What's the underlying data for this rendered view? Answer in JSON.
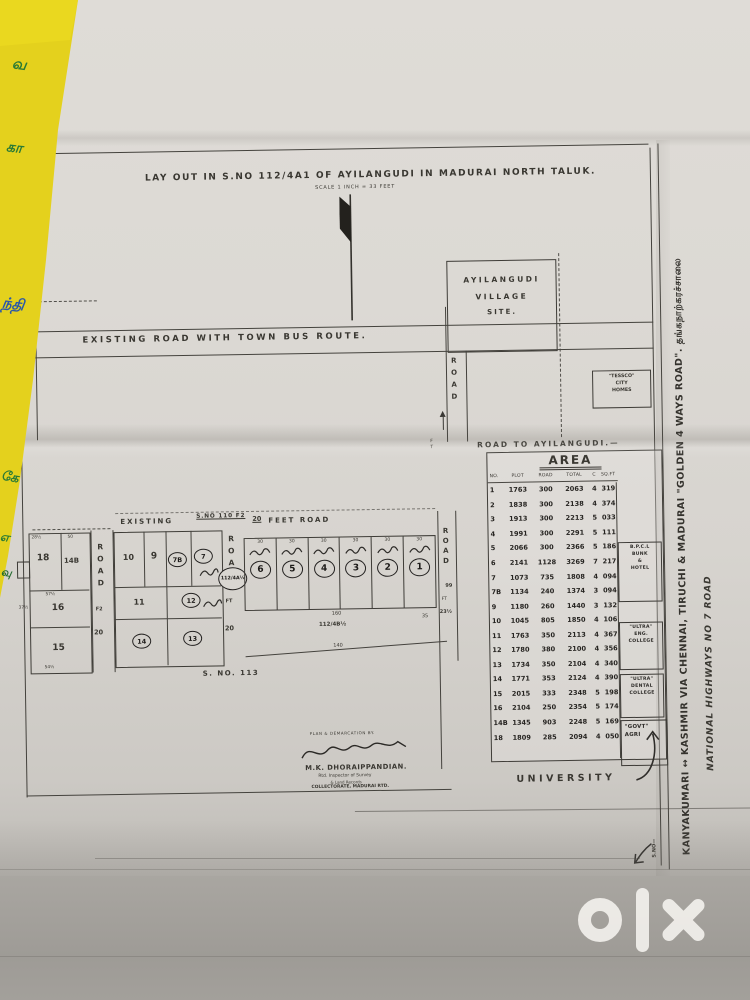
{
  "plan": {
    "title": "LAY OUT IN S.NO 112/4A1 OF AYILANGUDI IN MADURAI NORTH TALUK.",
    "scale": "SCALE 1 INCH = 33 FEET",
    "village_site": [
      "AYILANGUDI",
      "VILLAGE",
      "SITE."
    ],
    "tessco": [
      "\"TESSCO\"",
      "CITY",
      "HOMES"
    ],
    "bus_road_label": "EXISTING ROAD WITH TOWN BUS ROUTE.",
    "road_to_ayilangudi": "ROAD TO AYILANGUDI.—",
    "corridor": {
      "word": "ROAD",
      "ft": "FT"
    },
    "highway": {
      "line1": "KANYAKUMARI ↔ KASHMIR VIA CHENNAI, TIRUCHI & MADURAI \"GOLDEN 4 WAYS ROAD\". தங்கநாற்கரச்சாலை",
      "line2": "NATIONAL HIGHWAYS NO 7 ROAD",
      "sno": "S.NO—"
    },
    "feet_road": {
      "p1": "EXISTING",
      "p2": "S.NO 110 F2",
      "p3": "20",
      "p4": "FEET ROAD"
    },
    "sno113": "S. NO. 113",
    "parcel_a": "112/4A½",
    "parcel_b": "112/4B½",
    "plots": {
      "left": [
        "18",
        "14B",
        "16",
        "15"
      ],
      "mid_plain": [
        "10",
        "9",
        "11"
      ],
      "mid_circled": [
        "7B",
        "7",
        "12",
        "14",
        "13"
      ],
      "front": [
        {
          "n": "6"
        },
        {
          "n": "5"
        },
        {
          "n": "4"
        },
        {
          "n": "3"
        },
        {
          "n": "2"
        },
        {
          "n": "1"
        }
      ]
    },
    "roads": {
      "r1": {
        "num": "20",
        "unit": "F2",
        "word": "ROAD"
      },
      "r2": {
        "num": "20",
        "unit": "FT",
        "word": "ROAD"
      },
      "r3": {
        "word": "ROAD",
        "num": "99",
        "unit": "FT",
        "width": "23½"
      }
    },
    "dims": {
      "w30": "30",
      "a": "28½",
      "b": "50",
      "c": "57½",
      "d": "54½",
      "e": "37½",
      "f": "160",
      "g": "140",
      "h": "35"
    },
    "university": "UNIVERSITY",
    "signature": {
      "heading": "PLAN & DEMARCATION BY.",
      "name": "M.K. DHORAIPPANDIAN.",
      "line1": "Rtd. Inspector of Survey",
      "line2": "& Land Records",
      "line3": "COLLECTORATE, MADURAI RTD."
    },
    "area_table": {
      "title": "AREA",
      "headers": [
        "NO.",
        "PLOT",
        "ROAD",
        "TOTAL",
        "C",
        "SQ.FT"
      ],
      "rows": [
        {
          "n": "1",
          "p": "1763",
          "r": "300",
          "t": "2063",
          "c": "4",
          "s": "319"
        },
        {
          "n": "2",
          "p": "1838",
          "r": "300",
          "t": "2138",
          "c": "4",
          "s": "374"
        },
        {
          "n": "3",
          "p": "1913",
          "r": "300",
          "t": "2213",
          "c": "5",
          "s": "033"
        },
        {
          "n": "4",
          "p": "1991",
          "r": "300",
          "t": "2291",
          "c": "5",
          "s": "111"
        },
        {
          "n": "5",
          "p": "2066",
          "r": "300",
          "t": "2366",
          "c": "5",
          "s": "186"
        },
        {
          "n": "6",
          "p": "2141",
          "r": "1128",
          "t": "3269",
          "c": "7",
          "s": "217"
        },
        {
          "n": "7",
          "p": "1073",
          "r": "735",
          "t": "1808",
          "c": "4",
          "s": "094"
        },
        {
          "n": "7B",
          "p": "1134",
          "r": "240",
          "t": "1374",
          "c": "3",
          "s": "094"
        },
        {
          "n": "9",
          "p": "1180",
          "r": "260",
          "t": "1440",
          "c": "3",
          "s": "132"
        },
        {
          "n": "10",
          "p": "1045",
          "r": "805",
          "t": "1850",
          "c": "4",
          "s": "106"
        },
        {
          "n": "11",
          "p": "1763",
          "r": "350",
          "t": "2113",
          "c": "4",
          "s": "367"
        },
        {
          "n": "12",
          "p": "1780",
          "r": "380",
          "t": "2100",
          "c": "4",
          "s": "356"
        },
        {
          "n": "13",
          "p": "1734",
          "r": "350",
          "t": "2104",
          "c": "4",
          "s": "340"
        },
        {
          "n": "14",
          "p": "1771",
          "r": "353",
          "t": "2124",
          "c": "4",
          "s": "390"
        },
        {
          "n": "15",
          "p": "2015",
          "r": "333",
          "t": "2348",
          "c": "5",
          "s": "198"
        },
        {
          "n": "16",
          "p": "2104",
          "r": "250",
          "t": "2354",
          "c": "5",
          "s": "174"
        },
        {
          "n": "14B",
          "p": "1345",
          "r": "903",
          "t": "2248",
          "c": "5",
          "s": "169"
        },
        {
          "n": "18",
          "p": "1809",
          "r": "285",
          "t": "2094",
          "c": "4",
          "s": "050"
        }
      ],
      "notes": {
        "bpcl": [
          "B.P.C.L",
          "BUNK",
          "&",
          "HOTEL"
        ],
        "eng": [
          "\"ULTRA\"",
          "ENG.",
          "COLLEGE"
        ],
        "dental": [
          "\"ULTRA\"",
          "DENTAL",
          "COLLEGE"
        ],
        "agri": [
          "\"GOVT\"",
          "AGRI"
        ]
      }
    }
  },
  "photo": {
    "watermark": "olx",
    "strip_glyphs": [
      "வ",
      "கா",
      "ந்தி",
      "கே",
      "எ",
      "வு"
    ]
  }
}
